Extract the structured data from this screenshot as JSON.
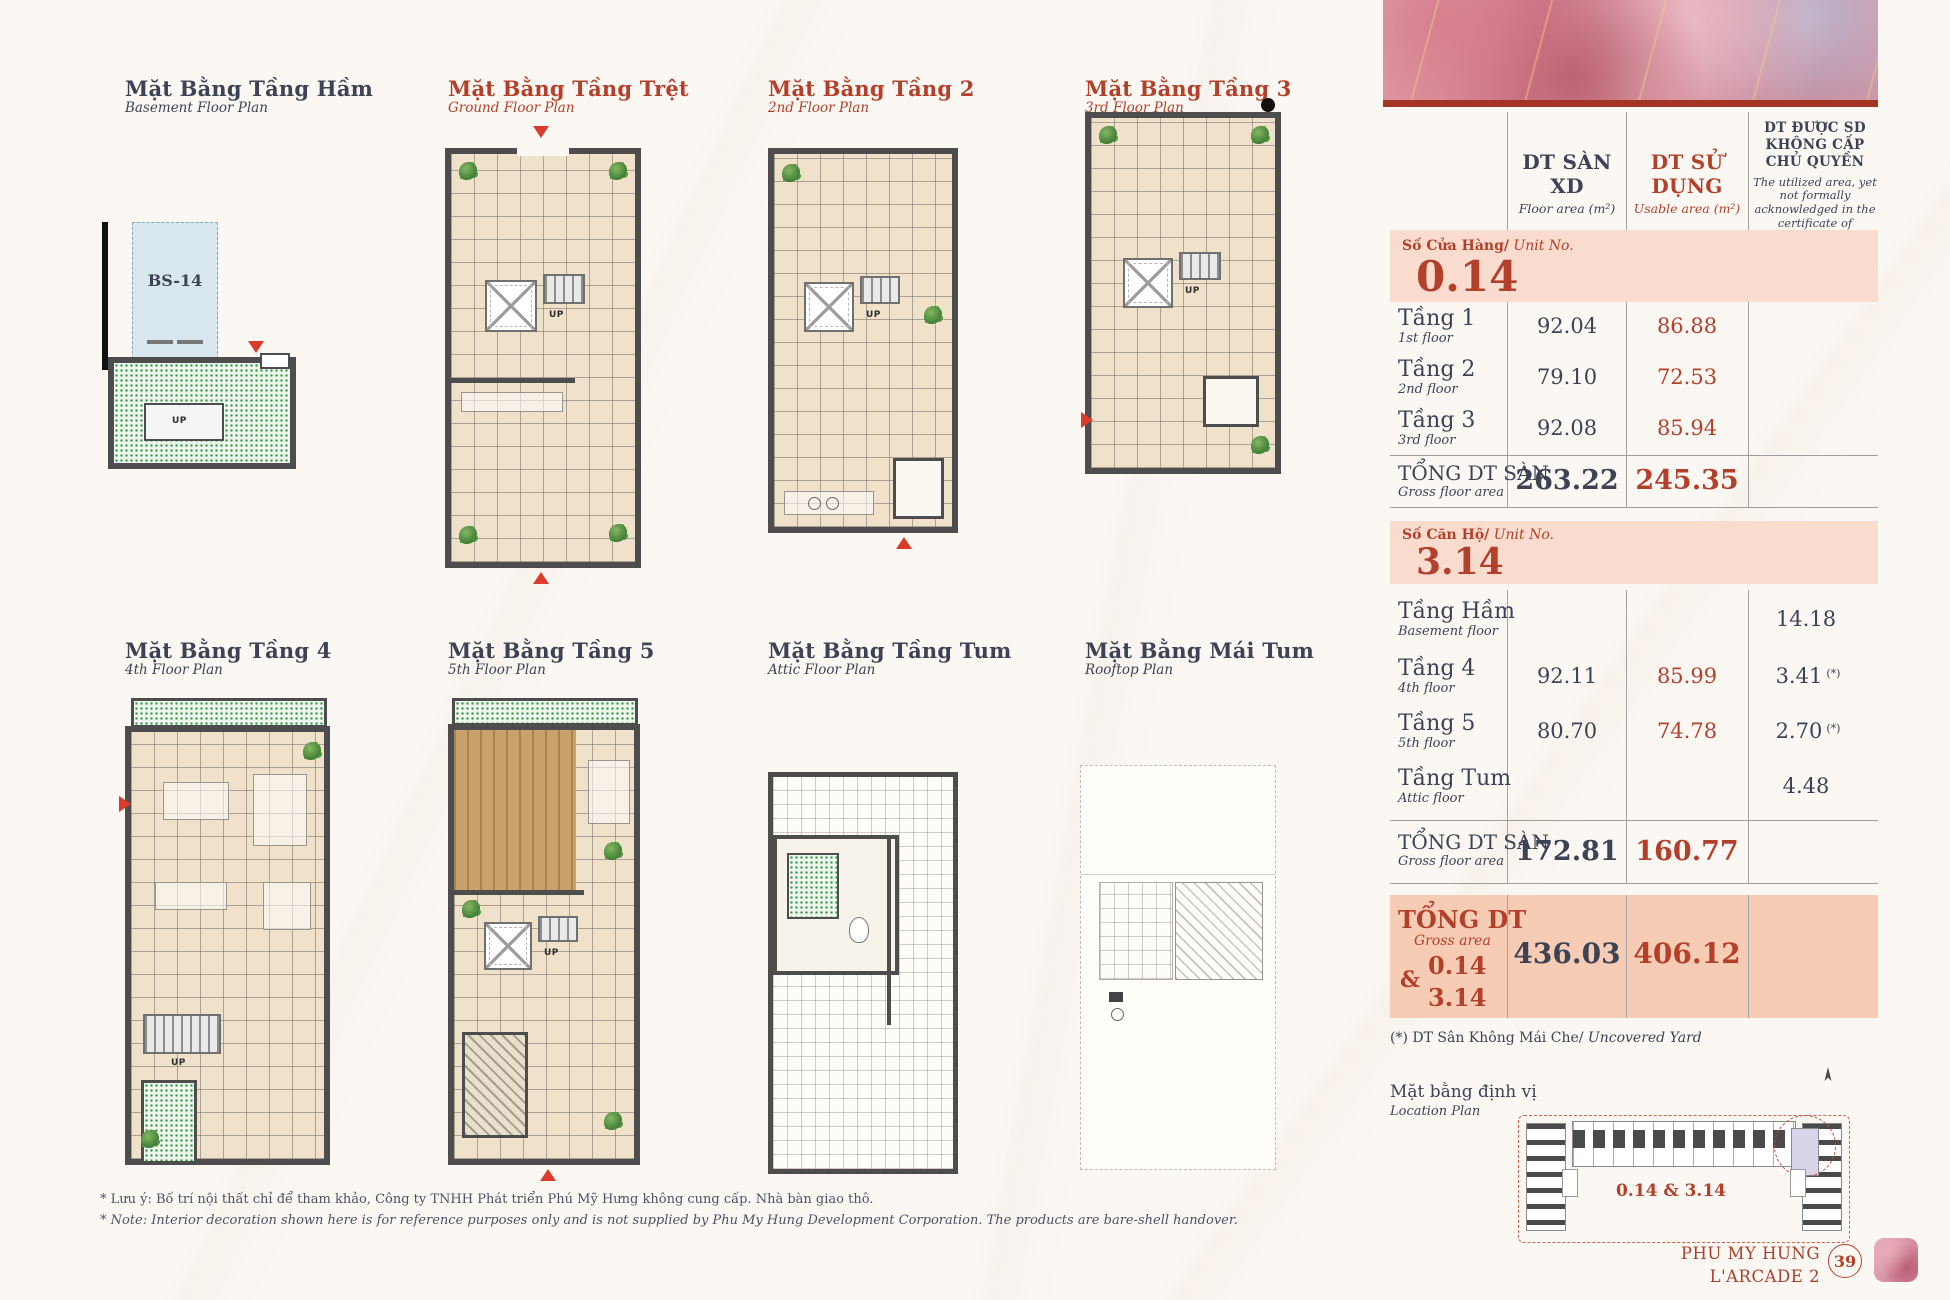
{
  "palette": {
    "accent_red": "#b2402b",
    "dark_navy": "#3d4254",
    "salmon": "#f9dcce",
    "salmon_deep": "#f6cdb4"
  },
  "plans": [
    {
      "title": "Mặt Bằng Tầng Hầm",
      "subtitle": "Basement Floor Plan"
    },
    {
      "title": "Mặt Bằng Tầng Trệt",
      "subtitle": "Ground Floor Plan"
    },
    {
      "title": "Mặt Bằng Tầng 2",
      "subtitle": "2nd Floor Plan"
    },
    {
      "title": "Mặt Bằng Tầng 3",
      "subtitle": "3rd Floor Plan"
    },
    {
      "title": "Mặt Bằng Tầng 4",
      "subtitle": "4th Floor Plan"
    },
    {
      "title": "Mặt Bằng Tầng 5",
      "subtitle": "5th Floor Plan"
    },
    {
      "title": "Mặt Bằng Tầng Tum",
      "subtitle": "Attic Floor Plan"
    },
    {
      "title": "Mặt Bằng Mái Tum",
      "subtitle": "Rooftop Plan"
    }
  ],
  "labels": {
    "up": "UP",
    "bs14": "BS-14"
  },
  "table": {
    "header": {
      "col1_title": "DT SÀN XD",
      "col1_sub": "Floor area (m²)",
      "col2_title": "DT SỬ DỤNG",
      "col2_sub": "Usable area (m²)",
      "col3_title": "DT ĐƯỢC SD KHÔNG CẤP CHỦ QUYỀN",
      "col3_sub": "The utilized area, yet not formally acknowledged in the certificate of ownership"
    },
    "unit_shop": {
      "banner_label": "Số Cửa Hàng/",
      "banner_label_en": " Unit No.",
      "unit_no": "0.14",
      "rows": [
        {
          "label": "Tầng 1",
          "label_en": "1st floor",
          "floor_area": "92.04",
          "usable_area": "86.88",
          "uncert_area": "",
          "star": ""
        },
        {
          "label": "Tầng 2",
          "label_en": "2nd floor",
          "floor_area": "79.10",
          "usable_area": "72.53",
          "uncert_area": "",
          "star": ""
        },
        {
          "label": "Tầng 3",
          "label_en": "3rd floor",
          "floor_area": "92.08",
          "usable_area": "85.94",
          "uncert_area": "",
          "star": ""
        }
      ],
      "total": {
        "label": "TỔNG DT SÀN",
        "label_en": "Gross floor area",
        "floor_area": "263.22",
        "usable_area": "245.35"
      }
    },
    "unit_apartment": {
      "banner_label": "Số Căn Hộ/",
      "banner_label_en": " Unit No.",
      "unit_no": "3.14",
      "rows": [
        {
          "label": "Tầng Hầm",
          "label_en": "Basement floor",
          "floor_area": "",
          "usable_area": "",
          "uncert_area": "14.18",
          "star": ""
        },
        {
          "label": "Tầng 4",
          "label_en": "4th floor",
          "floor_area": "92.11",
          "usable_area": "85.99",
          "uncert_area": "3.41",
          "star": "(*)"
        },
        {
          "label": "Tầng 5",
          "label_en": "5th floor",
          "floor_area": "80.70",
          "usable_area": "74.78",
          "uncert_area": "2.70",
          "star": "(*)"
        },
        {
          "label": "Tầng Tum",
          "label_en": "Attic floor",
          "floor_area": "",
          "usable_area": "",
          "uncert_area": "4.48",
          "star": ""
        }
      ],
      "total": {
        "label": "TỔNG DT SÀN",
        "label_en": "Gross floor area",
        "floor_area": "172.81",
        "usable_area": "160.77"
      }
    },
    "grand_total": {
      "label": "TỔNG DT",
      "label_en": "Gross area",
      "amp": "&",
      "unit1": "0.14",
      "unit2": "3.14",
      "floor_area": "436.03",
      "usable_area": "406.12"
    },
    "footnote": "(*) DT Sân Không Mái Che/",
    "footnote_en": " Uncovered Yard"
  },
  "location": {
    "title": "Mặt bằng định vị",
    "subtitle": "Location Plan",
    "unit_label": "0.14 & 3.14"
  },
  "footer": {
    "brand_line1": "PHU MY HUNG",
    "brand_line2": "L'ARCADE 2",
    "page_number": "39"
  },
  "notes": {
    "vi": "* Lưu ý: Bố trí nội thất chỉ để tham khảo, Công ty TNHH Phát triển Phú Mỹ Hưng không cung cấp. Nhà bàn giao thô.",
    "en": "* Note: Interior decoration shown here is for reference purposes only and is not supplied by Phu My Hung Development Corporation. The products are bare-shell handover."
  }
}
